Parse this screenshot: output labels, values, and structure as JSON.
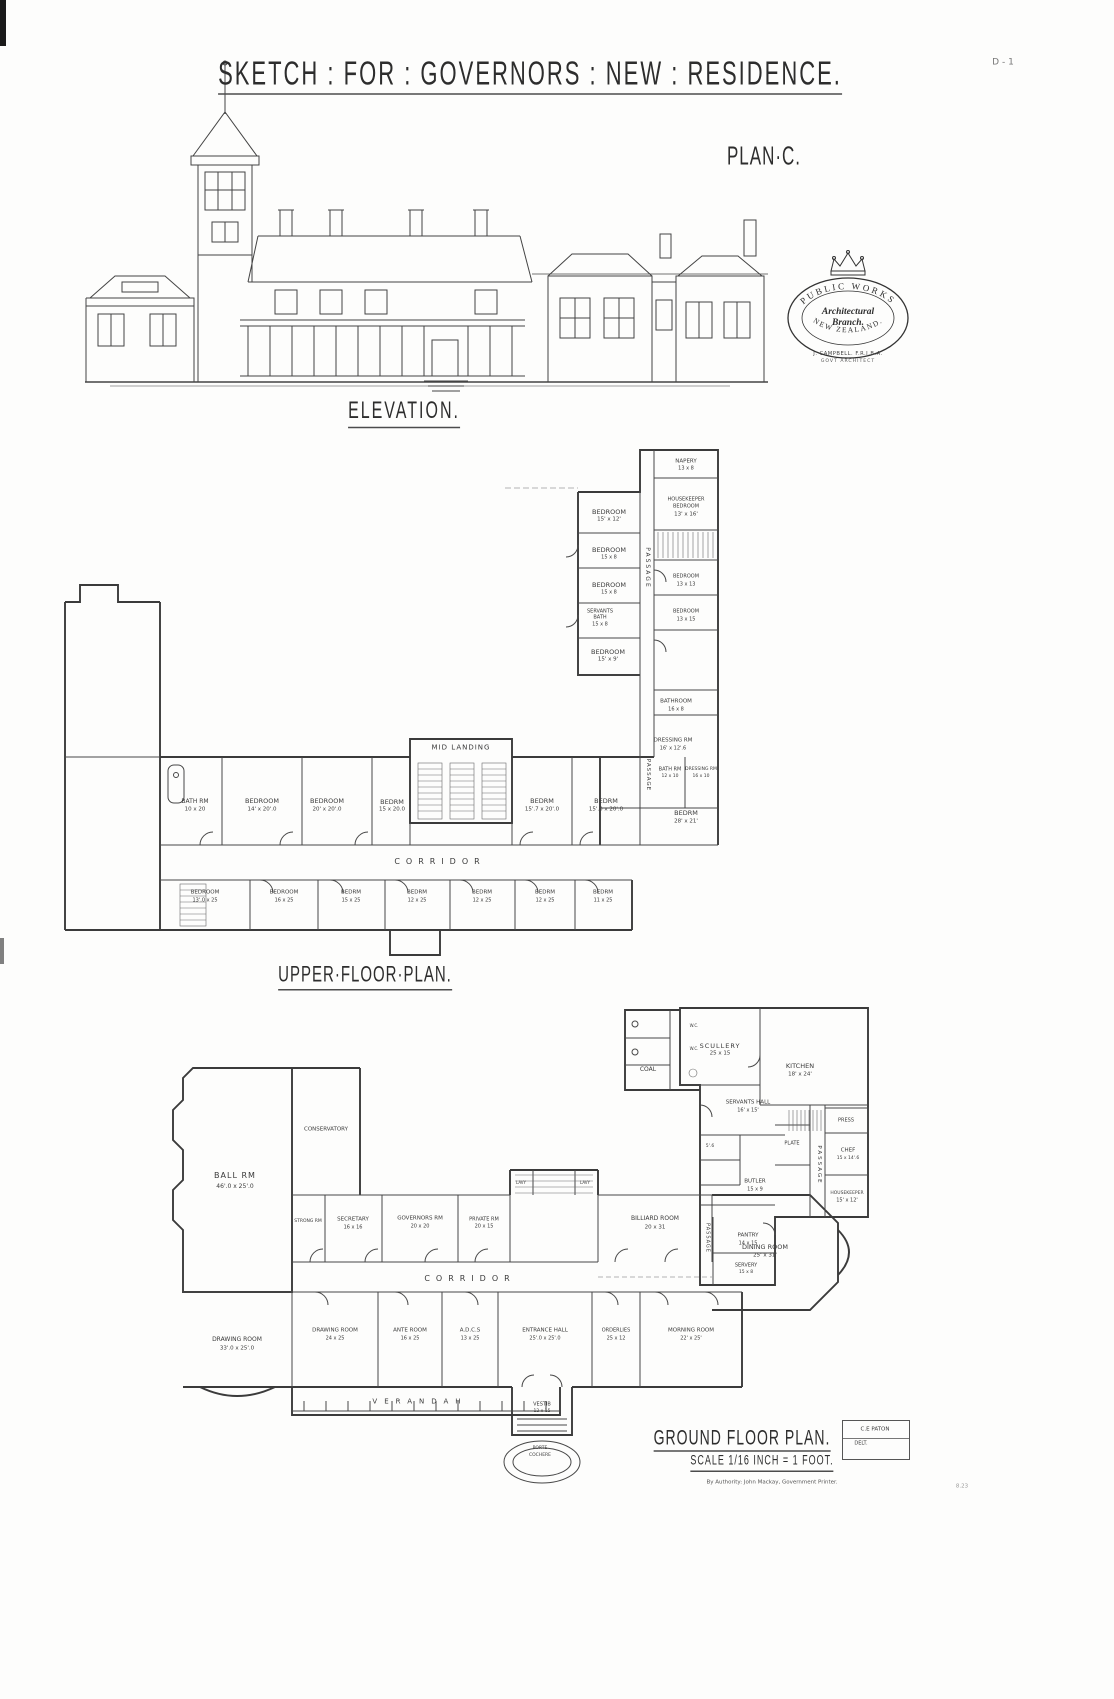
{
  "stamp": {
    "arc_top": "PUBLIC WORKS",
    "center_line1": "Architectural",
    "center_line2": "Branch.",
    "arc_bottom": "NEW ZEALAND.",
    "architect": "J. CAMPBELL. F.R.I.B.A.",
    "architect_title": "GOVT ARCHITECT"
  },
  "labels": [
    {
      "n": "sheet-code",
      "t": "D - 1",
      "x": 1003,
      "y": 63,
      "s": 9,
      "c": "#777"
    },
    {
      "n": "main-title",
      "t": "SKETCH : FOR : GOVERNORS : NEW : RESIDENCE.",
      "x": 530,
      "y": 76,
      "s": 22,
      "u": 1,
      "a": 1,
      "ls": 2
    },
    {
      "n": "plan-letter",
      "t": "PLAN·C.",
      "x": 764,
      "y": 156,
      "s": 17,
      "a": 1,
      "ls": 1
    },
    {
      "n": "elevation-title",
      "t": "ELEVATION.",
      "x": 404,
      "y": 414,
      "s": 16,
      "u": 1,
      "a": 1,
      "ls": 2
    },
    {
      "n": "upper-plan-title",
      "t": "UPPER·FLOOR·PLAN.",
      "x": 365,
      "y": 977,
      "s": 15,
      "u": 1,
      "a": 1,
      "ls": 1
    },
    {
      "n": "ground-plan-title",
      "t": "GROUND FLOOR PLAN.",
      "x": 742,
      "y": 1439,
      "s": 14,
      "u": 1,
      "a": 1,
      "ls": 1
    },
    {
      "n": "scale-note",
      "t": "SCALE 1/16 INCH = 1 FOOT.",
      "x": 762,
      "y": 1463,
      "s": 9,
      "u": 1,
      "a": 1,
      "ls": 1
    },
    {
      "n": "draughtsman",
      "t": "C.E PATON",
      "x": 875,
      "y": 1430,
      "s": 5.5
    },
    {
      "n": "delt-note",
      "t": "DELT.",
      "x": 861,
      "y": 1444,
      "s": 5
    },
    {
      "n": "authority-note",
      "t": "By Authority: John Mackay, Government Printer.",
      "x": 772,
      "y": 1483,
      "s": 5.5,
      "c": "#555"
    },
    {
      "n": "print-ref",
      "t": "8.23",
      "x": 962,
      "y": 1487,
      "s": 5.5,
      "c": "#999"
    },
    {
      "t": "NAPERY",
      "x": 686,
      "y": 462,
      "s": 5.5
    },
    {
      "t": "13 x 8",
      "x": 686,
      "y": 469,
      "s": 5
    },
    {
      "t": "BEDROOM",
      "x": 609,
      "y": 512,
      "s": 6.5
    },
    {
      "t": "15' x 12'",
      "x": 609,
      "y": 520,
      "s": 5.5
    },
    {
      "t": "HOUSEKEEPER",
      "x": 686,
      "y": 500,
      "s": 5
    },
    {
      "t": "BEDROOM",
      "x": 686,
      "y": 507,
      "s": 5
    },
    {
      "t": "13' x 16'",
      "x": 686,
      "y": 515,
      "s": 5.5
    },
    {
      "t": "BEDROOM",
      "x": 609,
      "y": 550,
      "s": 6.5
    },
    {
      "t": "15 x 8",
      "x": 609,
      "y": 558,
      "s": 5
    },
    {
      "t": "BEDROOM",
      "x": 609,
      "y": 585,
      "s": 6.5
    },
    {
      "t": "15 x 8",
      "x": 609,
      "y": 593,
      "s": 5
    },
    {
      "t": "SERVANTS",
      "x": 600,
      "y": 612,
      "s": 5
    },
    {
      "t": "BATH",
      "x": 600,
      "y": 618,
      "s": 5
    },
    {
      "t": "15 x 8",
      "x": 600,
      "y": 625,
      "s": 5
    },
    {
      "t": "BEDROOM",
      "x": 686,
      "y": 577,
      "s": 5
    },
    {
      "t": "13 x 13",
      "x": 686,
      "y": 585,
      "s": 5
    },
    {
      "t": "BEDROOM",
      "x": 686,
      "y": 612,
      "s": 5
    },
    {
      "t": "13 x 15",
      "x": 686,
      "y": 620,
      "s": 5
    },
    {
      "t": "BEDROOM",
      "x": 608,
      "y": 652,
      "s": 6.5
    },
    {
      "t": "15' x 9'",
      "x": 608,
      "y": 660,
      "s": 5.5
    },
    {
      "t": "PASSAGE",
      "x": 647,
      "y": 568,
      "s": 6,
      "r": 90,
      "ls": 2
    },
    {
      "t": "BATHROOM",
      "x": 676,
      "y": 702,
      "s": 5.5
    },
    {
      "t": "16 x 8",
      "x": 676,
      "y": 710,
      "s": 5
    },
    {
      "t": "DRESSING RM",
      "x": 673,
      "y": 741,
      "s": 5.5
    },
    {
      "t": "16' x 12'.6",
      "x": 673,
      "y": 749,
      "s": 5
    },
    {
      "t": "BATH RM",
      "x": 670,
      "y": 770,
      "s": 5
    },
    {
      "t": "12 x 10",
      "x": 670,
      "y": 777,
      "s": 4.5
    },
    {
      "t": "DRESSING RM",
      "x": 701,
      "y": 770,
      "s": 4.5
    },
    {
      "t": "16 x 10",
      "x": 701,
      "y": 777,
      "s": 4.5
    },
    {
      "t": "BEDRM",
      "x": 686,
      "y": 813,
      "s": 6.5
    },
    {
      "t": "28' x 21'",
      "x": 686,
      "y": 822,
      "s": 5.5
    },
    {
      "t": "PASSAGE",
      "x": 647,
      "y": 775,
      "s": 5.5,
      "r": 90,
      "ls": 1
    },
    {
      "t": "BATH RM",
      "x": 195,
      "y": 802,
      "s": 6
    },
    {
      "t": "10 x 20",
      "x": 195,
      "y": 810,
      "s": 5.5
    },
    {
      "t": "BEDROOM",
      "x": 262,
      "y": 801,
      "s": 6.5
    },
    {
      "t": "14' x 20'.0",
      "x": 262,
      "y": 810,
      "s": 5.5
    },
    {
      "t": "BEDROOM",
      "x": 327,
      "y": 801,
      "s": 6.5
    },
    {
      "t": "20' x 20'.0",
      "x": 327,
      "y": 810,
      "s": 5.5
    },
    {
      "t": "BEDRM",
      "x": 392,
      "y": 802,
      "s": 6.5
    },
    {
      "t": "15 x 20.0",
      "x": 392,
      "y": 810,
      "s": 5.5
    },
    {
      "t": "MID LANDING",
      "x": 461,
      "y": 748,
      "s": 7,
      "ls": 1
    },
    {
      "t": "BEDRM",
      "x": 542,
      "y": 801,
      "s": 6.5
    },
    {
      "t": "15'.7 x 20'.0",
      "x": 542,
      "y": 810,
      "s": 5.5
    },
    {
      "t": "BEDRM",
      "x": 606,
      "y": 801,
      "s": 6.5
    },
    {
      "t": "15'.0 x 20'.0",
      "x": 606,
      "y": 810,
      "s": 5.5
    },
    {
      "t": "CORRIDOR",
      "x": 440,
      "y": 862,
      "s": 8,
      "ls": 6
    },
    {
      "t": "BEDROOM",
      "x": 205,
      "y": 893,
      "s": 5.5
    },
    {
      "t": "13'.0 x 25",
      "x": 205,
      "y": 901,
      "s": 5
    },
    {
      "t": "BEDROOM",
      "x": 284,
      "y": 893,
      "s": 5.5
    },
    {
      "t": "16 x 25",
      "x": 284,
      "y": 901,
      "s": 5
    },
    {
      "t": "BEDRM",
      "x": 351,
      "y": 893,
      "s": 5.5
    },
    {
      "t": "15 x 25",
      "x": 351,
      "y": 901,
      "s": 5
    },
    {
      "t": "BEDRM",
      "x": 417,
      "y": 893,
      "s": 5.5
    },
    {
      "t": "12 x 25",
      "x": 417,
      "y": 901,
      "s": 5
    },
    {
      "t": "BEDRM",
      "x": 482,
      "y": 893,
      "s": 5.5
    },
    {
      "t": "12 x 25",
      "x": 482,
      "y": 901,
      "s": 5
    },
    {
      "t": "BEDRM",
      "x": 545,
      "y": 893,
      "s": 5.5
    },
    {
      "t": "12 x 25",
      "x": 545,
      "y": 901,
      "s": 5
    },
    {
      "t": "BEDRM",
      "x": 603,
      "y": 893,
      "s": 5.5
    },
    {
      "t": "11 x 25",
      "x": 603,
      "y": 901,
      "s": 5
    },
    {
      "t": "W.C.",
      "x": 694,
      "y": 1026,
      "s": 4
    },
    {
      "t": "W.C.",
      "x": 694,
      "y": 1049,
      "s": 4
    },
    {
      "t": "COAL",
      "x": 648,
      "y": 1070,
      "s": 6
    },
    {
      "t": "SCULLERY",
      "x": 720,
      "y": 1046,
      "s": 6.5,
      "ls": 1
    },
    {
      "t": "25 x 15",
      "x": 720,
      "y": 1054,
      "s": 5.5
    },
    {
      "t": "KITCHEN",
      "x": 800,
      "y": 1066,
      "s": 6.5
    },
    {
      "t": "18' x 24'",
      "x": 800,
      "y": 1075,
      "s": 5.5
    },
    {
      "t": "SERVANTS HALL",
      "x": 748,
      "y": 1103,
      "s": 5.5
    },
    {
      "t": "16' x 15'",
      "x": 748,
      "y": 1111,
      "s": 5
    },
    {
      "t": "PRESS",
      "x": 846,
      "y": 1121,
      "s": 5
    },
    {
      "t": "PLATE",
      "x": 792,
      "y": 1144,
      "s": 5
    },
    {
      "t": "CHEF",
      "x": 848,
      "y": 1151,
      "s": 5.5
    },
    {
      "t": "15 x 14'.6",
      "x": 848,
      "y": 1159,
      "s": 4.5
    },
    {
      "t": "BUTLER",
      "x": 755,
      "y": 1182,
      "s": 5.5
    },
    {
      "t": "15 x 9",
      "x": 755,
      "y": 1190,
      "s": 5
    },
    {
      "t": "PASSAGE",
      "x": 818,
      "y": 1165,
      "s": 5.5,
      "r": 90,
      "ls": 2
    },
    {
      "t": "HOUSEKEEPER",
      "x": 847,
      "y": 1194,
      "s": 4.5
    },
    {
      "t": "15' x 12'",
      "x": 847,
      "y": 1201,
      "s": 5
    },
    {
      "t": "5'.6",
      "x": 710,
      "y": 1147,
      "s": 4.5
    },
    {
      "t": "PANTRY",
      "x": 748,
      "y": 1236,
      "s": 5.5
    },
    {
      "t": "14 x 15",
      "x": 748,
      "y": 1244,
      "s": 5
    },
    {
      "t": "SERVERY",
      "x": 746,
      "y": 1266,
      "s": 5
    },
    {
      "t": "15 x 8",
      "x": 746,
      "y": 1273,
      "s": 4.5
    },
    {
      "t": "PASSAGE",
      "x": 707,
      "y": 1238,
      "s": 5,
      "r": 90,
      "ls": 1
    },
    {
      "t": "BALL RM",
      "x": 235,
      "y": 1176,
      "s": 8,
      "ls": 1
    },
    {
      "t": "46'.0 x 25'.0",
      "x": 235,
      "y": 1187,
      "s": 6
    },
    {
      "t": "CONSERVATORY",
      "x": 326,
      "y": 1130,
      "s": 5.5
    },
    {
      "t": "STRONG RM",
      "x": 308,
      "y": 1222,
      "s": 4.5
    },
    {
      "t": "SECRETARY",
      "x": 353,
      "y": 1220,
      "s": 5.5
    },
    {
      "t": "16 x 16",
      "x": 353,
      "y": 1228,
      "s": 5
    },
    {
      "t": "GOVERNORS RM",
      "x": 420,
      "y": 1219,
      "s": 5.5
    },
    {
      "t": "20 x 20",
      "x": 420,
      "y": 1227,
      "s": 5
    },
    {
      "t": "PRIVATE RM",
      "x": 484,
      "y": 1220,
      "s": 5
    },
    {
      "t": "20 x 15",
      "x": 484,
      "y": 1227,
      "s": 5
    },
    {
      "t": "LAVY",
      "x": 521,
      "y": 1183,
      "s": 4
    },
    {
      "t": "LAVY",
      "x": 585,
      "y": 1183,
      "s": 4
    },
    {
      "t": "BILLIARD ROOM",
      "x": 655,
      "y": 1219,
      "s": 6
    },
    {
      "t": "20 x 31",
      "x": 655,
      "y": 1228,
      "s": 5.5
    },
    {
      "t": "DINING ROOM",
      "x": 765,
      "y": 1247,
      "s": 6.5
    },
    {
      "t": "25' x 31'",
      "x": 765,
      "y": 1256,
      "s": 5.5
    },
    {
      "t": "CORRIDOR",
      "x": 470,
      "y": 1279,
      "s": 8,
      "ls": 6
    },
    {
      "t": "DRAWING ROOM",
      "x": 237,
      "y": 1340,
      "s": 6
    },
    {
      "t": "33'.0 x 25'.0",
      "x": 237,
      "y": 1349,
      "s": 5.5
    },
    {
      "t": "DRAWING ROOM",
      "x": 335,
      "y": 1331,
      "s": 5.5
    },
    {
      "t": "24 x 25",
      "x": 335,
      "y": 1339,
      "s": 5
    },
    {
      "t": "ANTE ROOM",
      "x": 410,
      "y": 1331,
      "s": 5.5
    },
    {
      "t": "16 x 25",
      "x": 410,
      "y": 1339,
      "s": 5
    },
    {
      "t": "A.D.C.S",
      "x": 470,
      "y": 1331,
      "s": 5.5
    },
    {
      "t": "13 x 25",
      "x": 470,
      "y": 1339,
      "s": 5
    },
    {
      "t": "ENTRANCE HALL",
      "x": 545,
      "y": 1331,
      "s": 5.5
    },
    {
      "t": "25'.0 x 25'.0",
      "x": 545,
      "y": 1339,
      "s": 5
    },
    {
      "t": "ORDERLIES",
      "x": 616,
      "y": 1331,
      "s": 5
    },
    {
      "t": "25 x 12",
      "x": 616,
      "y": 1339,
      "s": 5
    },
    {
      "t": "MORNING ROOM",
      "x": 691,
      "y": 1331,
      "s": 5.5
    },
    {
      "t": "22' x 25'",
      "x": 691,
      "y": 1339,
      "s": 5
    },
    {
      "t": "VERANDAH",
      "x": 420,
      "y": 1402,
      "s": 7,
      "ls": 7
    },
    {
      "t": "VESTIB",
      "x": 542,
      "y": 1405,
      "s": 5
    },
    {
      "t": "12 x 15",
      "x": 542,
      "y": 1412,
      "s": 4.5
    },
    {
      "t": "PORTE",
      "x": 540,
      "y": 1449,
      "s": 4.5
    },
    {
      "t": "COCHERE",
      "x": 540,
      "y": 1456,
      "s": 4.5
    }
  ]
}
